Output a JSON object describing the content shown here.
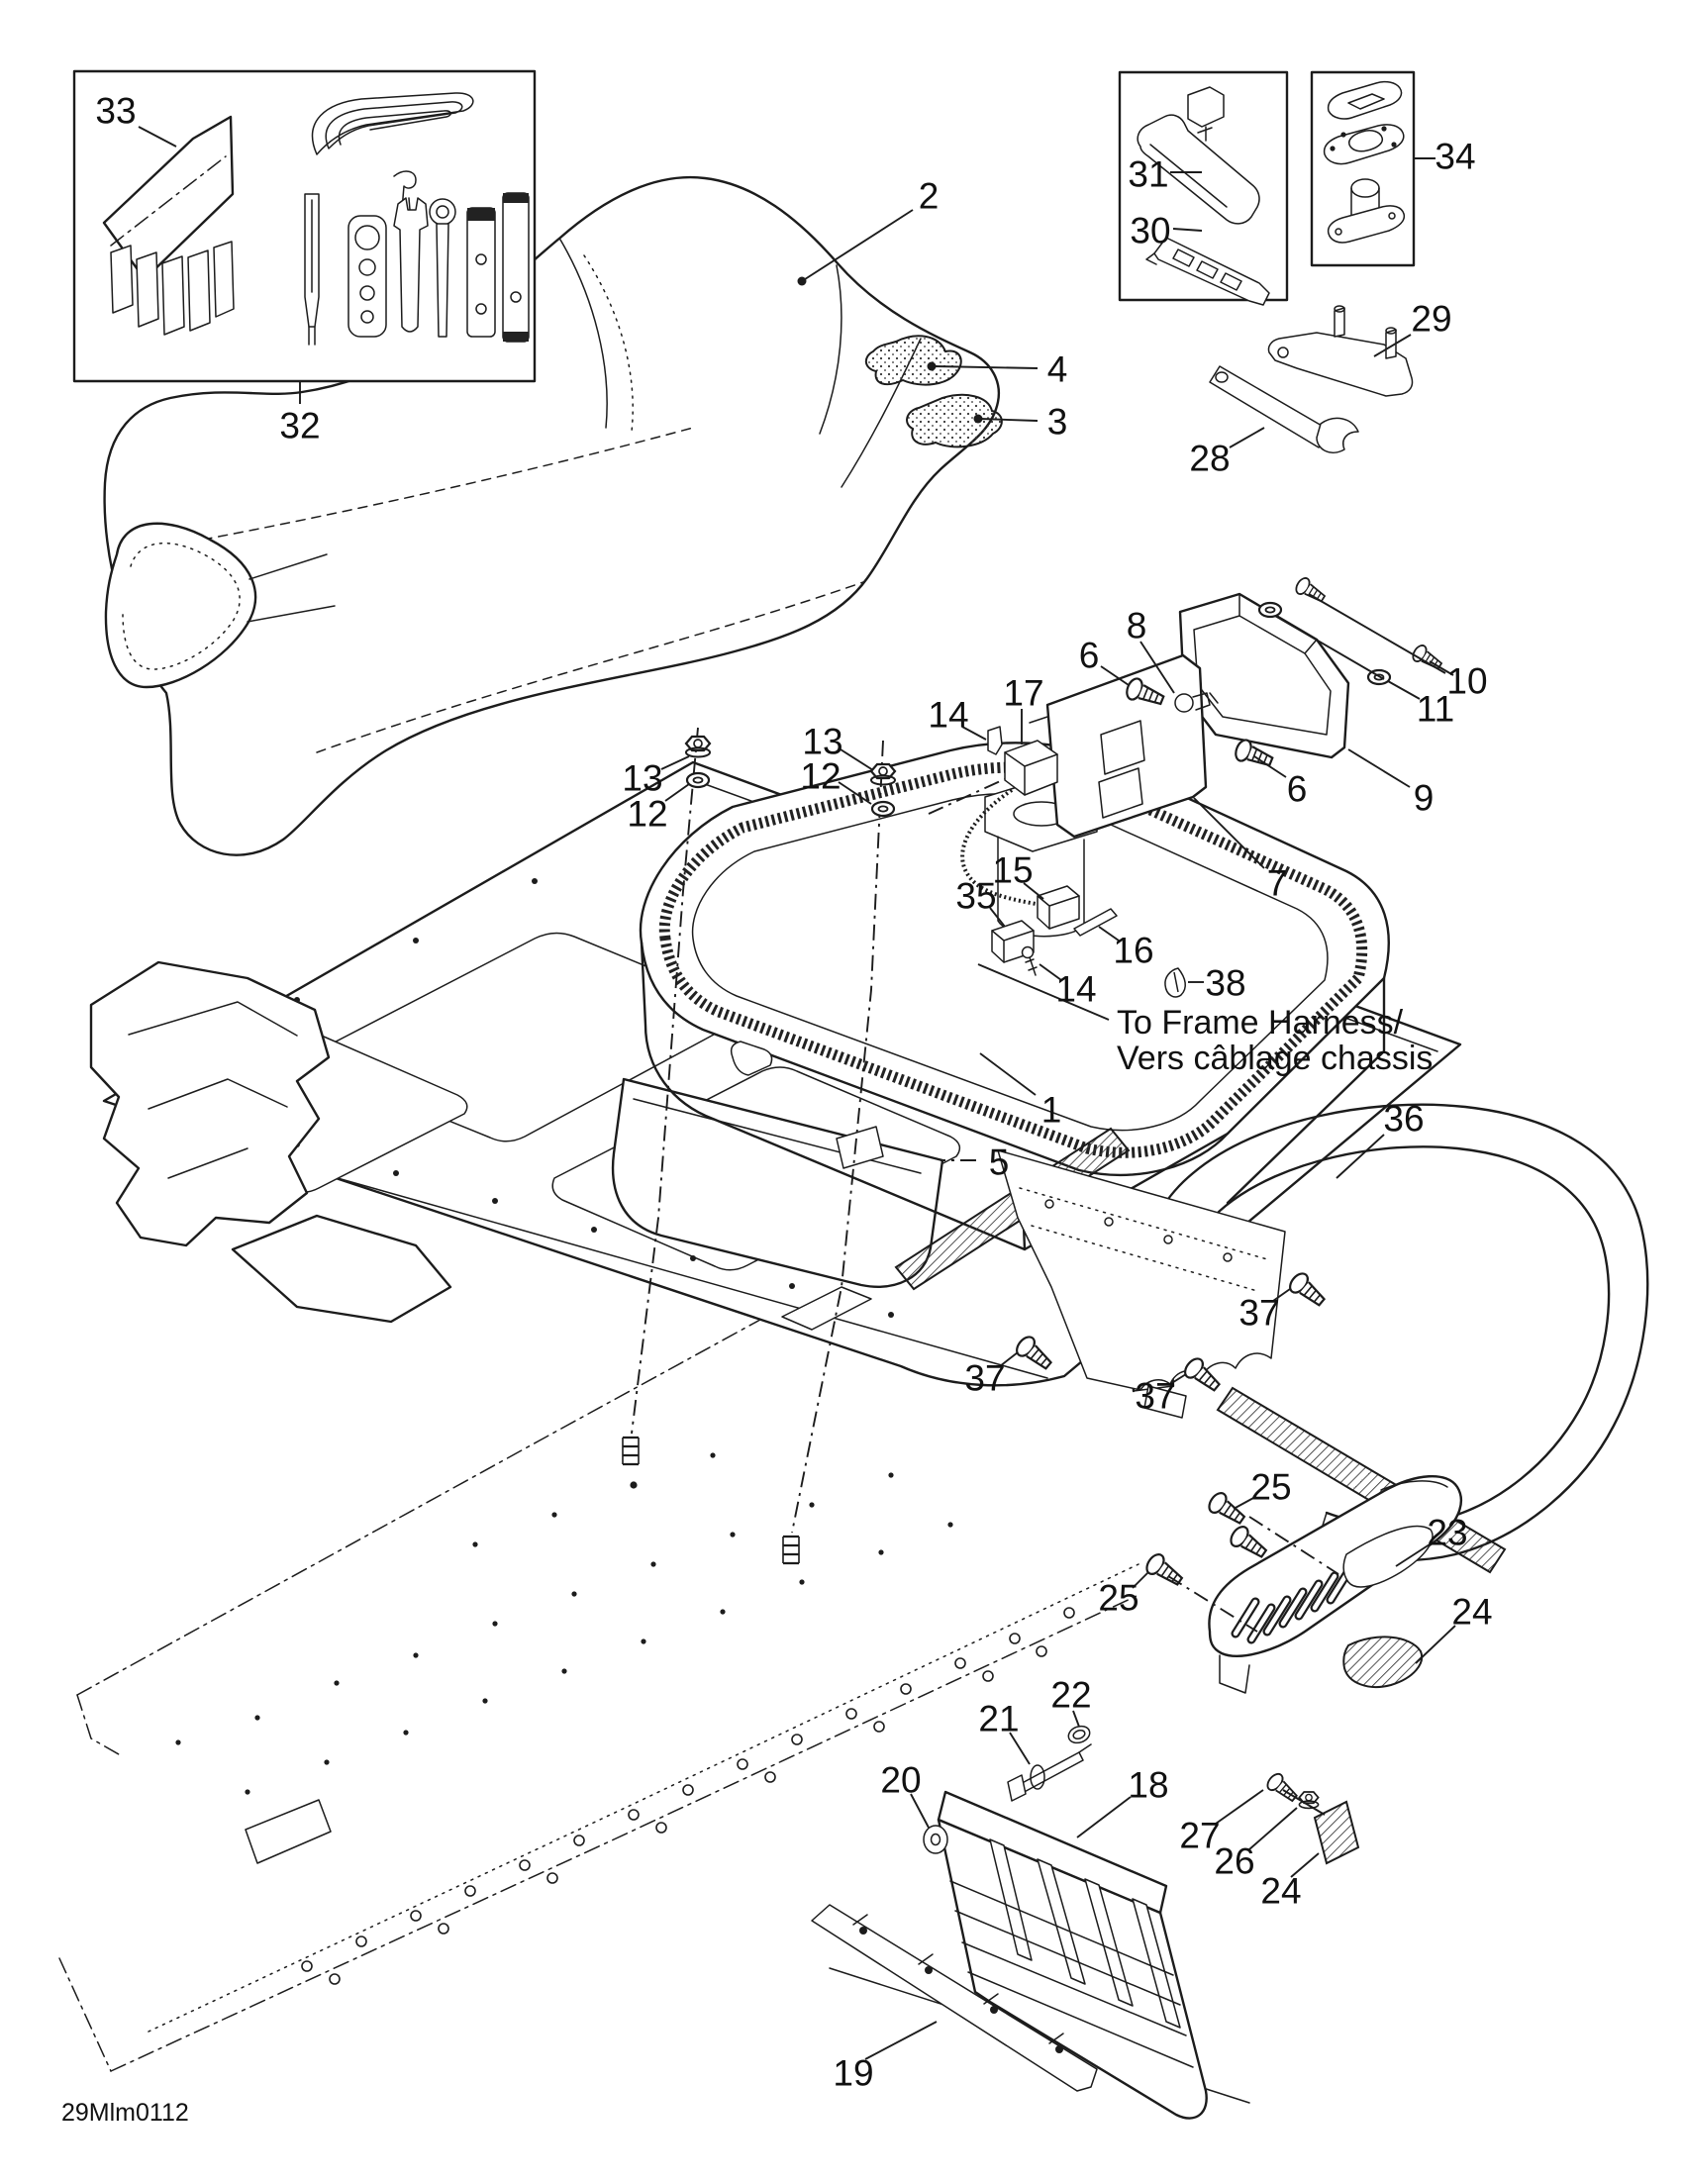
{
  "diagram": {
    "page_code": "29Mlm0112",
    "harness_note": {
      "line1": "To Frame Harness/",
      "line2": "Vers câblage chassis"
    },
    "callouts": [
      {
        "label": "33"
      },
      {
        "label": "32"
      },
      {
        "label": "2"
      },
      {
        "label": "4"
      },
      {
        "label": "3"
      },
      {
        "label": "31"
      },
      {
        "label": "30"
      },
      {
        "label": "34"
      },
      {
        "label": "29"
      },
      {
        "label": "28"
      },
      {
        "label": "6"
      },
      {
        "label": "8"
      },
      {
        "label": "10"
      },
      {
        "label": "11"
      },
      {
        "label": "9"
      },
      {
        "label": "6"
      },
      {
        "label": "7"
      },
      {
        "label": "13"
      },
      {
        "label": "12"
      },
      {
        "label": "13"
      },
      {
        "label": "12"
      },
      {
        "label": "14"
      },
      {
        "label": "17"
      },
      {
        "label": "15"
      },
      {
        "label": "35"
      },
      {
        "label": "16"
      },
      {
        "label": "14"
      },
      {
        "label": "38"
      },
      {
        "label": "1"
      },
      {
        "label": "5"
      },
      {
        "label": "36"
      },
      {
        "label": "37"
      },
      {
        "label": "37"
      },
      {
        "label": "37"
      },
      {
        "label": "25"
      },
      {
        "label": "25"
      },
      {
        "label": "23"
      },
      {
        "label": "24"
      },
      {
        "label": "22"
      },
      {
        "label": "21"
      },
      {
        "label": "20"
      },
      {
        "label": "18"
      },
      {
        "label": "27"
      },
      {
        "label": "26"
      },
      {
        "label": "24"
      },
      {
        "label": "19"
      }
    ]
  }
}
